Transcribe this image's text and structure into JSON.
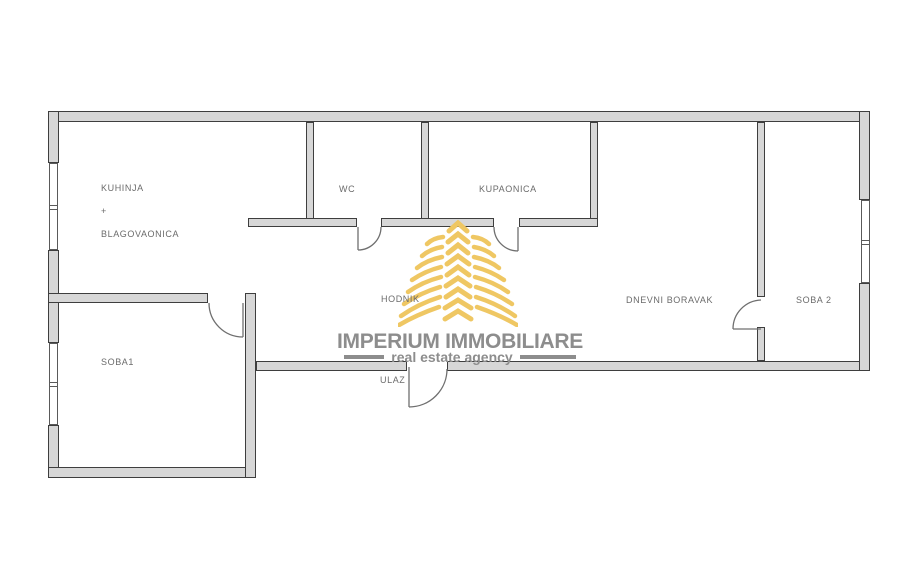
{
  "rooms": {
    "kuhinja": {
      "line1": "KUHINJA",
      "line2": "+",
      "line3": "BLAGOVAONICA"
    },
    "wc": {
      "label": "WC"
    },
    "kupaonica": {
      "label": "KUPAONICA"
    },
    "hodnik": {
      "label": "HODNIK"
    },
    "dnevni_boravak": {
      "label": "DNEVNI BORAVAK"
    },
    "soba2": {
      "label": "SOBA 2"
    },
    "soba1": {
      "label": "SOBA1"
    },
    "ulaz": {
      "label": "ULAZ"
    }
  },
  "logo": {
    "title": "IMPERIUM IMMOBILIARE",
    "subtitle": "real estate agency",
    "icon": "palm-tree-logo-icon",
    "gold": "#EFC763",
    "text_gray": "#8D8D8D"
  },
  "colors": {
    "background": "#FFFFFF",
    "wall_fill": "#D7D7D7",
    "wall_outline": "#3E3E3E",
    "window_line": "#5A5A5A",
    "door_line": "#6F6F6F",
    "label_text": "#6B6B6B"
  }
}
